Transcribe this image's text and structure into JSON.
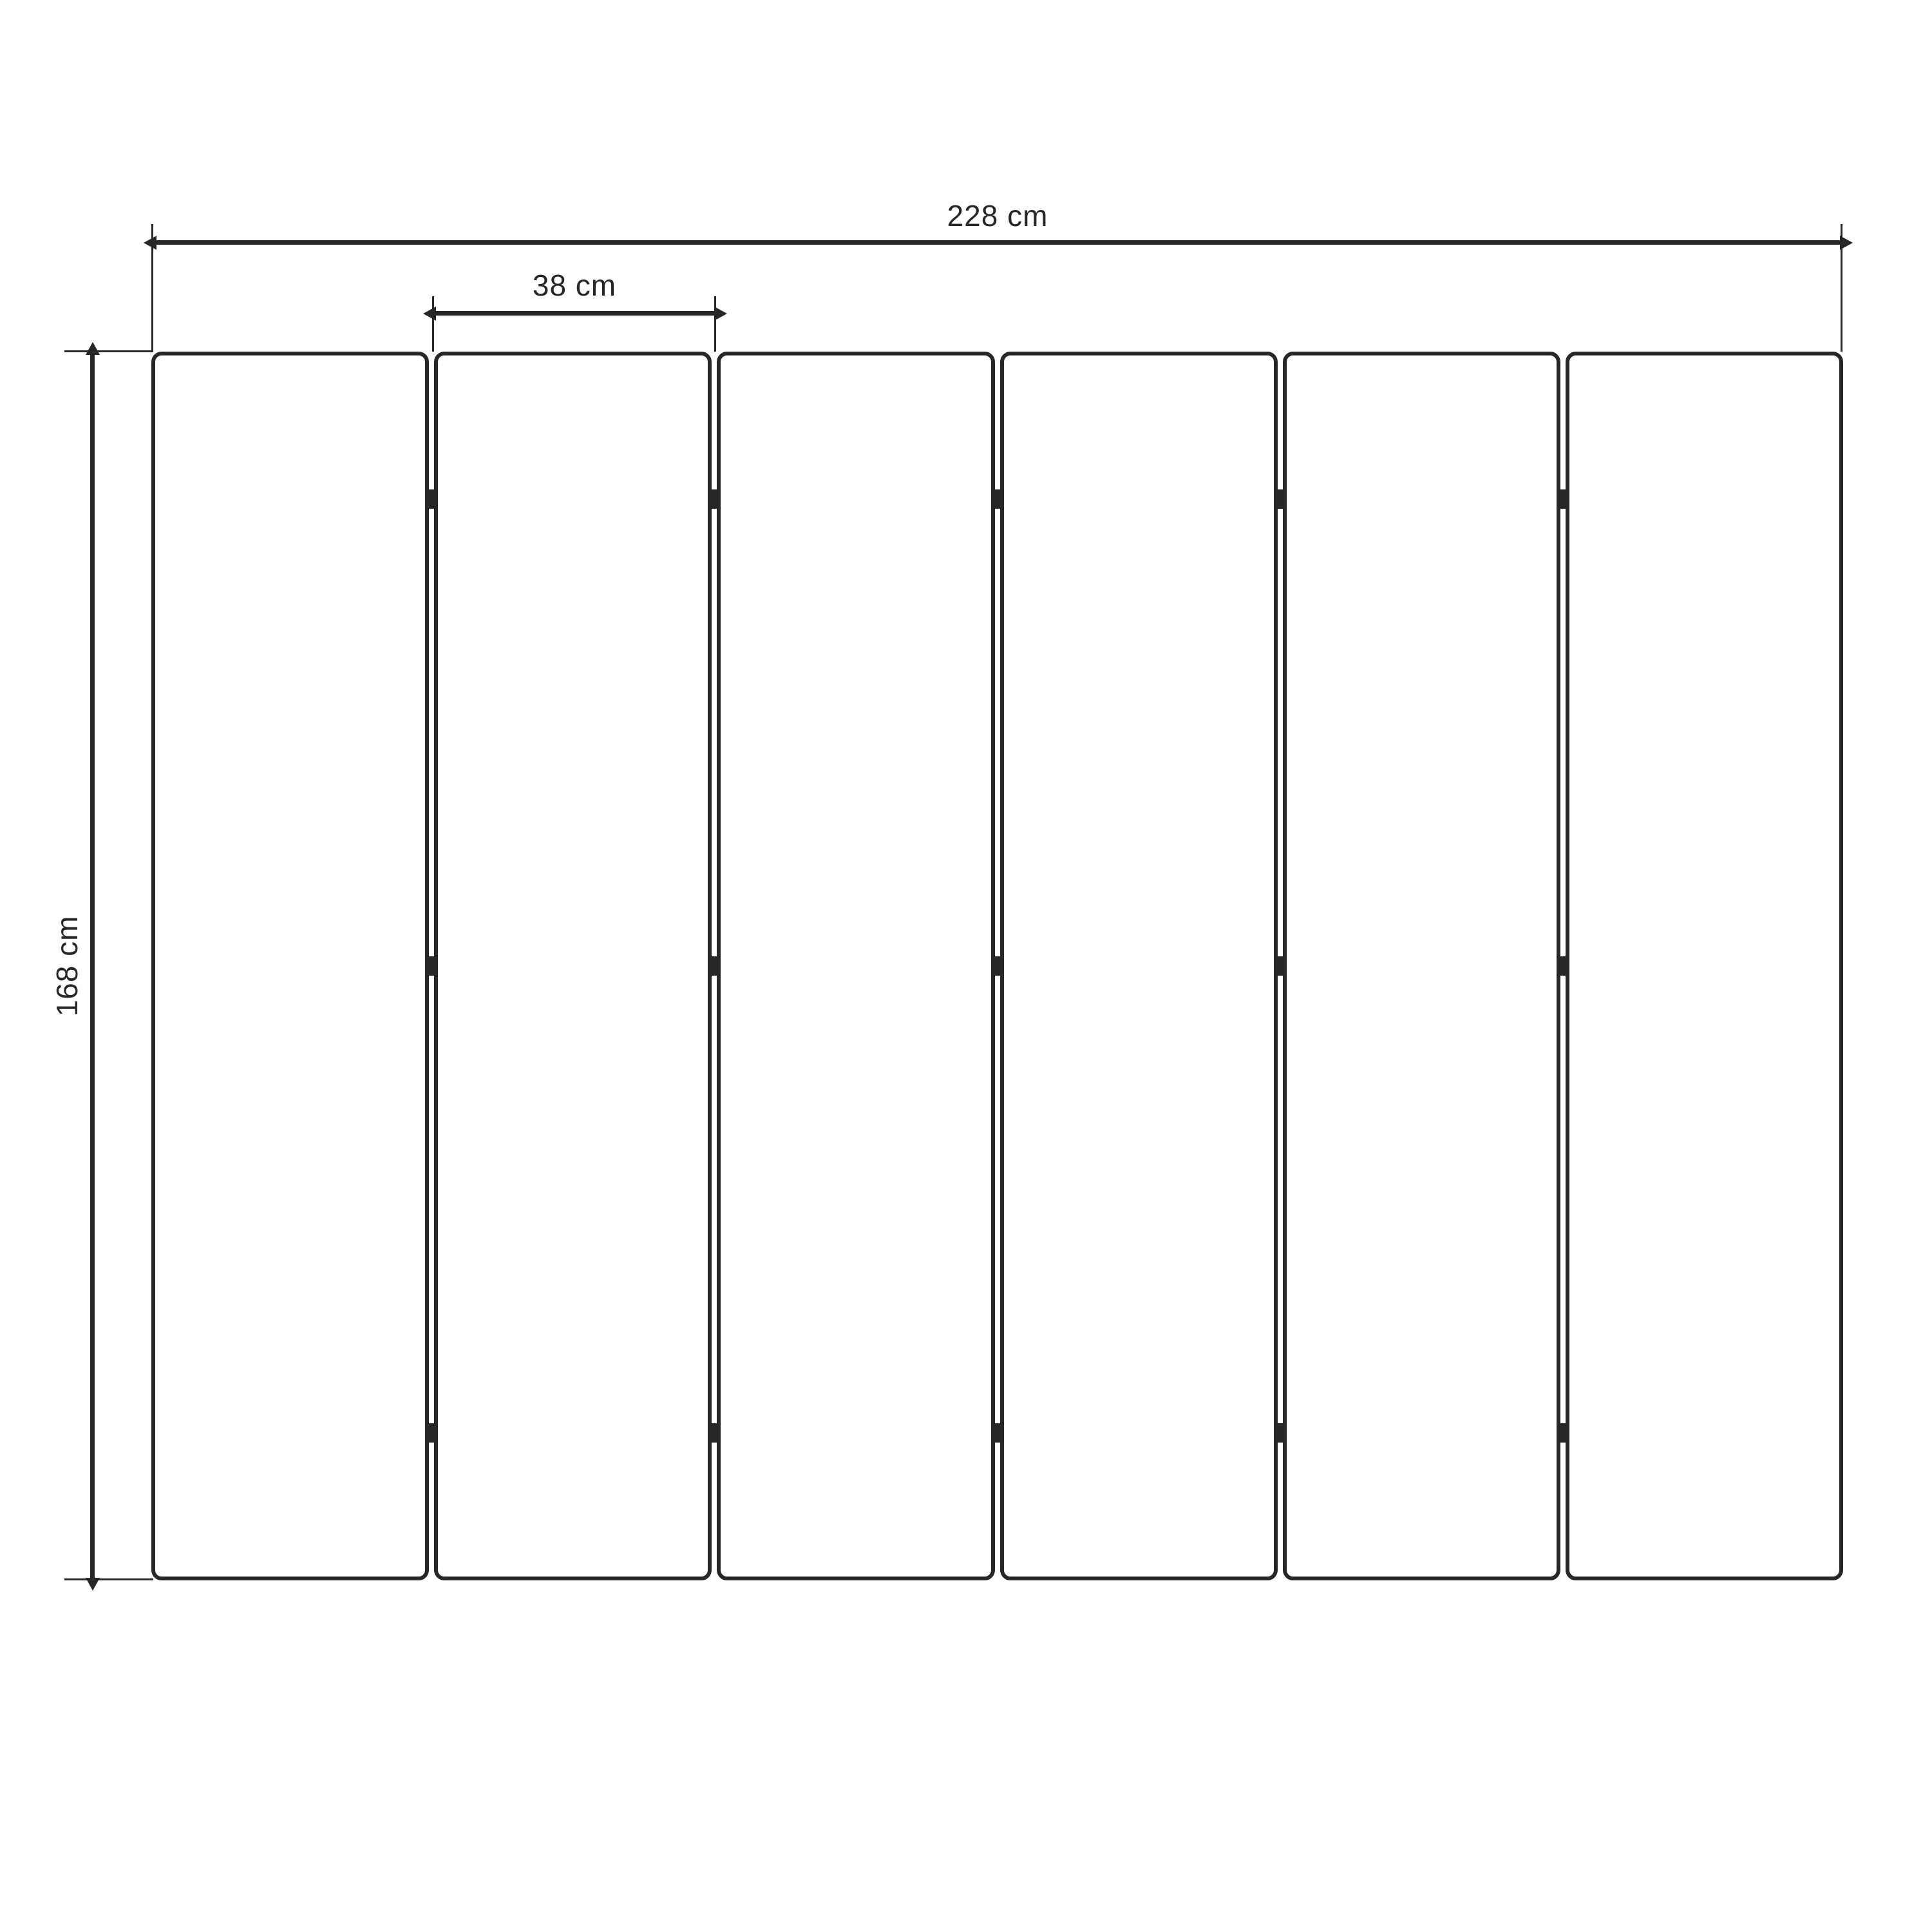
{
  "diagram": {
    "background_color": "#ffffff",
    "line_color": "#27272a",
    "panel_count": 6,
    "hinges_per_gap": 3,
    "dimensions": {
      "total_width": {
        "label": "228 cm"
      },
      "panel_width": {
        "label": "38 cm"
      },
      "height": {
        "label": "168 cm"
      }
    }
  }
}
